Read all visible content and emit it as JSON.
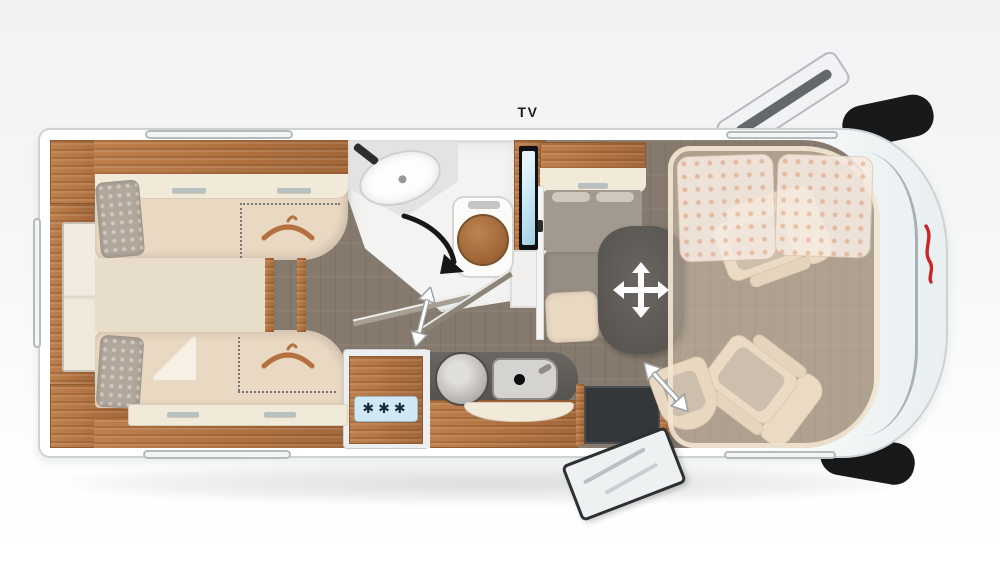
{
  "scene": {
    "type": "motorhome-floorplan",
    "view": "top-down",
    "vehicle_front": "right",
    "zones": [
      "twin-bed-bedroom",
      "bathroom",
      "kitchen",
      "dinette",
      "entry",
      "driver-cab-with-dropdown-bed"
    ]
  },
  "labels": {
    "tv": "TV"
  },
  "fridge": {
    "snowflakes": "✱✱✱"
  },
  "icons": {
    "hanger": "clothes-hanger-arc",
    "snowflakes": "freezer-stars",
    "shower_arrow": "curved-rotation-arrow",
    "door_arrow": "double-headed-swing-arrow",
    "table_arrow": "four-way-move-cross",
    "seat_arrow": "double-headed-swivel-arrow",
    "brand": "red-brand-logo"
  },
  "colors": {
    "body": "#ffffff",
    "body_edge": "#cdd2d4",
    "floor": "#857a6d",
    "wood": "#bd7f4c",
    "wood_dark": "#a2673a",
    "upholstery": "#e9d8c2",
    "upholstery_light": "#f2ead9",
    "bench_gray": "#a29a90",
    "seat_inset": "#b7afa2",
    "table": "#615c58",
    "fridge_panel": "#cfe8f4",
    "tv_screen": "#c8e7f4",
    "step_dark": "#33373a",
    "accent_red": "#c92627",
    "hanger": "#b5713f"
  }
}
